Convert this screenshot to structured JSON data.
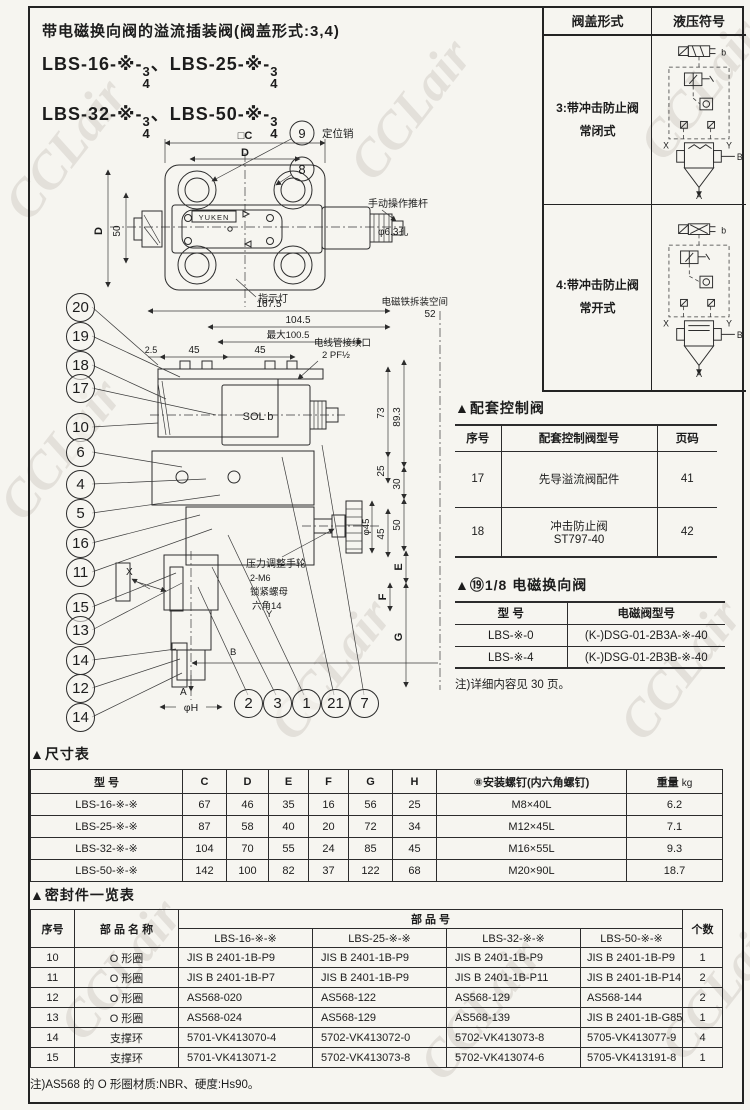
{
  "watermark": "CCLair",
  "header": {
    "title": "带电磁换向阀的溢流插装阀(阀盖形式:3,4)",
    "m1": "LBS-16-※-",
    "m2": "LBS-25-※-",
    "m3": "LBS-32-※-",
    "m4": "LBS-50-※-",
    "num": "3",
    "den": "4",
    "sep": "、"
  },
  "cover": {
    "headers": [
      "阀盖形式",
      "液压符号"
    ],
    "rows": [
      {
        "line1": "3:带冲击防止阀",
        "line2": "常闭式",
        "b": "b",
        "x": "X",
        "y": "Y",
        "B": "B",
        "A": "A"
      },
      {
        "line1": "4:带冲击防止阀",
        "line2": "常开式",
        "b": "b",
        "x": "X",
        "y": "Y",
        "B": "B",
        "A": "A"
      }
    ]
  },
  "drawing": {
    "plan": {
      "dim_c": "□C",
      "dim_d": "D",
      "dim_d_side": "D",
      "dim_50": "50",
      "brand": "YUKEN",
      "callout_9": "9",
      "pin_label": "定位销",
      "callout_8": "8",
      "pushrod": "手动操作推杆",
      "hole": "φ6.3孔",
      "indicator": "指示灯"
    },
    "front": {
      "dim_167": "167.5",
      "space1": "电磁铁拆装空间",
      "space2": "52",
      "dim_104": "104.5",
      "dim_100": "最大100.5",
      "dim_25a": "2.5",
      "dim_45a": "45",
      "dim_45b": "45",
      "conduit1": "电线管接续口",
      "conduit2": "2 PF½",
      "sol": "SOL b",
      "d73": "73",
      "d89": "89.3",
      "d25": "25",
      "d30": "30",
      "d50": "50",
      "d45": "45",
      "dphi45": "φ45",
      "handwheel": "压力调整手轮",
      "locknut1": "2-M6",
      "locknut2": "锁紧螺母",
      "locknut3": "六角14",
      "px": "X",
      "py": "Y",
      "pb": "B",
      "pa": "A",
      "de": "E",
      "df": "F",
      "dg": "G",
      "dphih": "φH"
    },
    "left_callouts": [
      "20",
      "19",
      "18",
      "17",
      "10",
      "6",
      "4",
      "5",
      "16",
      "11",
      "15",
      "13",
      "14",
      "12",
      "14"
    ],
    "bottom_callouts": [
      "2",
      "3",
      "1",
      "21",
      "7"
    ]
  },
  "control_table": {
    "title": "▲配套控制阀",
    "headers": [
      "序号",
      "配套控制阀型号",
      "页码"
    ],
    "rows": [
      {
        "no": "17",
        "name": "先导溢流阀配件",
        "name2": "",
        "page": "41"
      },
      {
        "no": "18",
        "name": "冲击防止阀",
        "name2": "ST797-40",
        "page": "42"
      }
    ]
  },
  "solenoid_table": {
    "title": "▲⑲1/8 电磁换向阀",
    "headers": [
      "型    号",
      "电磁阀型号"
    ],
    "rows": [
      [
        "LBS-※-0",
        "(K-)DSG-01-2B3A-※-40"
      ],
      [
        "LBS-※-4",
        "(K-)DSG-01-2B3B-※-40"
      ]
    ],
    "note": "注)详细内容见 30 页。"
  },
  "dim_table": {
    "title": "▲尺寸表",
    "headers": [
      "型    号",
      "C",
      "D",
      "E",
      "F",
      "G",
      "H",
      "⑧安装螺钉(内六角螺钉)"
    ],
    "weight_label": "重量",
    "weight_unit": "kg",
    "rows": [
      [
        "LBS-16-※-※",
        "67",
        "46",
        "35",
        "16",
        "56",
        "25",
        "M8×40L",
        "6.2"
      ],
      [
        "LBS-25-※-※",
        "87",
        "58",
        "40",
        "20",
        "72",
        "34",
        "M12×45L",
        "7.1"
      ],
      [
        "LBS-32-※-※",
        "104",
        "70",
        "55",
        "24",
        "85",
        "45",
        "M16×55L",
        "9.3"
      ],
      [
        "LBS-50-※-※",
        "142",
        "100",
        "82",
        "37",
        "122",
        "68",
        "M20×90L",
        "18.7"
      ]
    ]
  },
  "seal_table": {
    "title": "▲密封件一览表",
    "col_no": "序号",
    "col_name": "部 品 名 称",
    "col_part": "部        品        号",
    "col_qty": "个数",
    "sub": [
      "LBS-16-※-※",
      "LBS-25-※-※",
      "LBS-32-※-※",
      "LBS-50-※-※"
    ],
    "rows": [
      [
        "10",
        "O 形圈",
        "JIS B 2401-1B-P9",
        "JIS B 2401-1B-P9",
        "JIS B 2401-1B-P9",
        "JIS B 2401-1B-P9",
        "1"
      ],
      [
        "11",
        "O 形圈",
        "JIS B 2401-1B-P7",
        "JIS B 2401-1B-P9",
        "JIS B 2401-1B-P11",
        "JIS B 2401-1B-P14",
        "2"
      ],
      [
        "12",
        "O 形圈",
        "AS568-020",
        "AS568-122",
        "AS568-129",
        "AS568-144",
        "2"
      ],
      [
        "13",
        "O 形圈",
        "AS568-024",
        "AS568-129",
        "AS568-139",
        "JIS B 2401-1B-G85",
        "1"
      ],
      [
        "14",
        "支撑环",
        "5701-VK413070-4",
        "5702-VK413072-0",
        "5702-VK413073-8",
        "5705-VK413077-9",
        "4"
      ],
      [
        "15",
        "支撑环",
        "5701-VK413071-2",
        "5702-VK413073-8",
        "5702-VK413074-6",
        "5705-VK413191-8",
        "1"
      ]
    ],
    "note": "注)AS568 的 O 形圈材质:NBR、硬度:Hs90。"
  }
}
